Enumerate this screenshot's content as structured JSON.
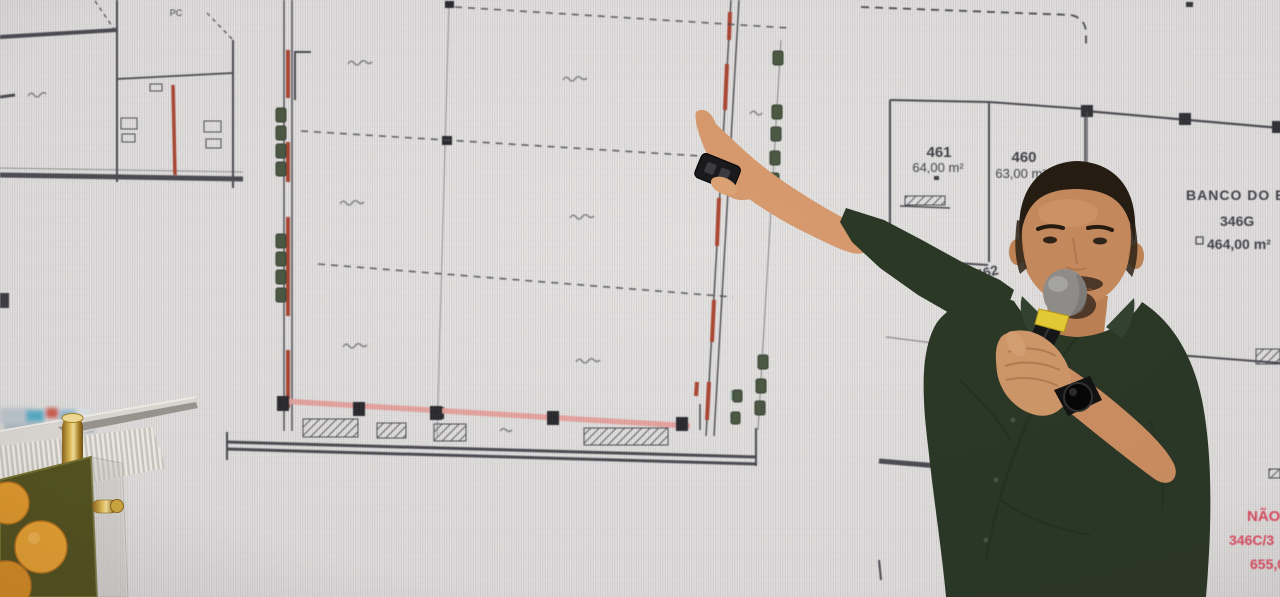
{
  "photo": {
    "objects": [
      "led-screen-floor-plan",
      "presenter",
      "microphone",
      "smartwatch",
      "presentation-clicker",
      "lectern"
    ]
  },
  "plan": {
    "labels": {
      "pc": "PC",
      "unit_461": "461",
      "unit_461_area": "64,00 m²",
      "unit_460": "460",
      "unit_460_area": "63,00 m²",
      "unit_462": "462",
      "bank_name": "BANCO DO B",
      "bank_unit": "346G",
      "bank_area": "464,00 m²",
      "partial_number_15": "15",
      "partial_number_1": "1"
    },
    "note": {
      "line1": "NÃO",
      "line2": "346C/3",
      "line3": "655,0"
    },
    "colors": {
      "line": "#44444a",
      "wall_highlight_red": "#b0452f",
      "floor_highlight_pink": "#efa7a0",
      "fixture_green": "#4a5840",
      "note_red": "#e84a5e",
      "screen_bg": "#e9e7e5"
    }
  },
  "presenter": {
    "shirt_color": "#2b3826",
    "mic_band_color": "#e6cc35"
  }
}
